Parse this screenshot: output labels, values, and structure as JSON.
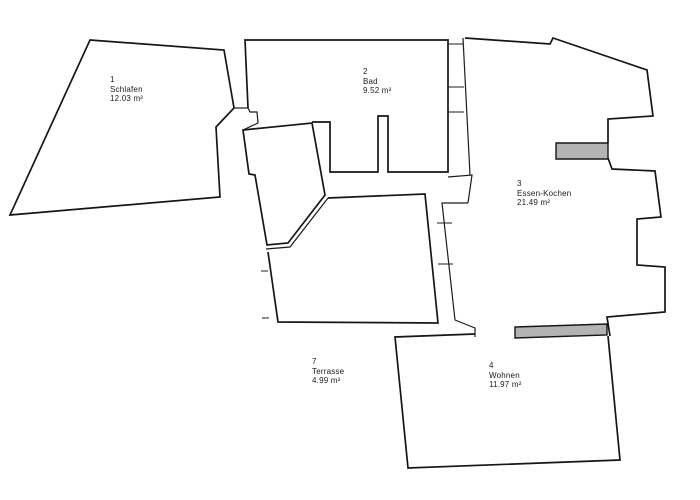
{
  "rooms": [
    {
      "number": "1",
      "name": "Schlafen",
      "area": "12.03 m²"
    },
    {
      "number": "2",
      "name": "Bad",
      "area": "9.52 m²"
    },
    {
      "number": "3",
      "name": "Essen-Kochen",
      "area": "21.49 m²"
    },
    {
      "number": "4",
      "name": "Wohnen",
      "area": "11.97 m²"
    },
    {
      "number": "7",
      "name": "Terrasse",
      "area": "4.99 m²"
    }
  ],
  "colors": {
    "background": "#ffffff",
    "wall": "#161616",
    "window_bar_fill": "#b3b3b3"
  }
}
